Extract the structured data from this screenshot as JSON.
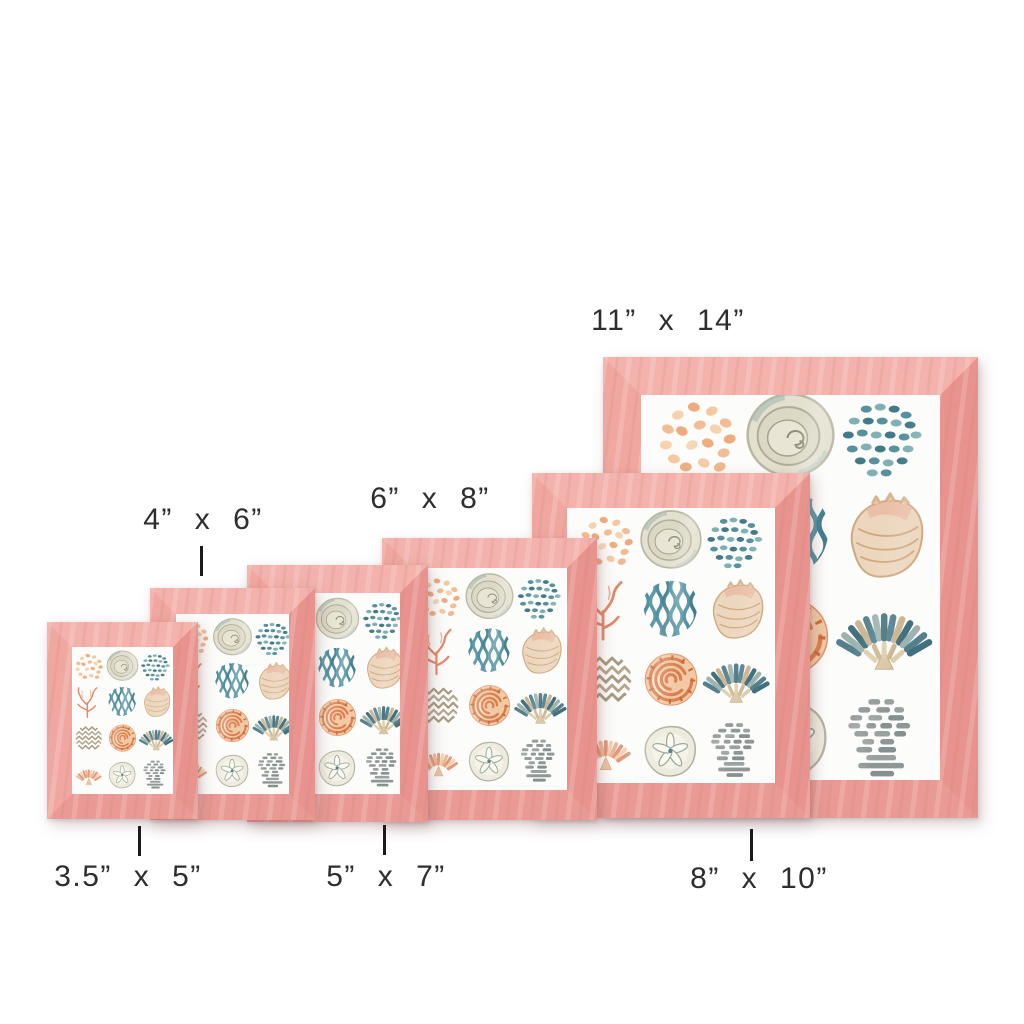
{
  "page": {
    "type": "product size comparison image",
    "background_color": "#ffffff"
  },
  "product": {
    "item": "pink wood picture frame with coastal seashell watercolor print",
    "frame_color_hex": "#ee9e99",
    "artwork_background_hex": "#fbfbf8"
  },
  "sizes": [
    {
      "id": "3.5x5",
      "label": "3.5” x 5”",
      "pointer": "tick-above-label"
    },
    {
      "id": "4x6",
      "label": "4” x 6”",
      "pointer": "tick-below-label"
    },
    {
      "id": "5x7",
      "label": "5” x 7”",
      "pointer": "tick-above-label"
    },
    {
      "id": "6x8",
      "label": "6” x 8”",
      "pointer": "none"
    },
    {
      "id": "8x10",
      "label": "8” x 10”",
      "pointer": "tick-above-label"
    },
    {
      "id": "11x14",
      "label": "11” x 14”",
      "pointer": "none"
    }
  ],
  "artwork_motifs": [
    "peach-pebble-dots",
    "round-snail-shell",
    "teal-dash-dots",
    "coral-branch",
    "teal-wave-stripes",
    "conch-shell",
    "taupe-chevron-patch",
    "orange-ammonite-spiral",
    "teal-scallop-fan",
    "peach-scallop-shell",
    "sand-dollar",
    "gray-striped-coral"
  ],
  "palette": {
    "frame_pink": "#ee9e99",
    "frame_pink_light": "#f5bcb4",
    "frame_pink_dark": "#e18b87",
    "teal": "#4e8e9b",
    "peach": "#eeae82",
    "coral": "#e08a6a",
    "tan": "#d9c6a4",
    "gray_green": "#8f9796",
    "label_text": "#2e2e2e"
  }
}
